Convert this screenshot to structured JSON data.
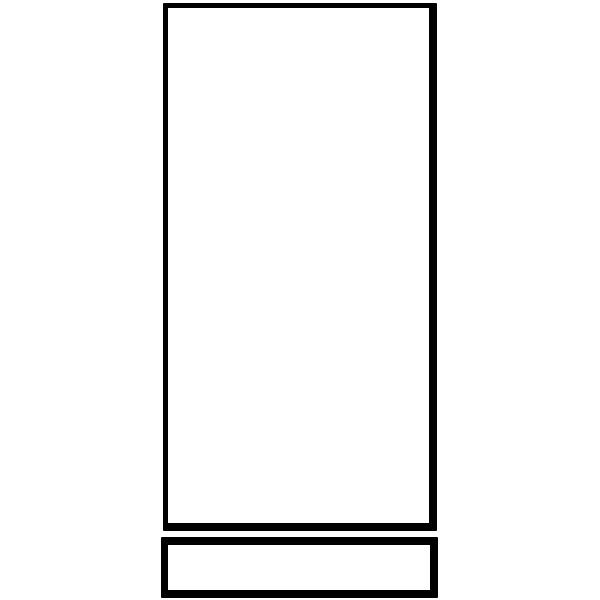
{
  "canvas": {
    "width": 600,
    "height": 600,
    "background": "#ffffff"
  },
  "colors": {
    "ink": "#000000",
    "fill": "#ffffff",
    "background": "#ffffff"
  },
  "drawing": {
    "description": "Black outline line drawing of a tall vertical rectangle panel with a short horizontal rectangle base below it; no text or labels",
    "shapes": {
      "main_panel": {
        "left": 163,
        "top": 3,
        "width": 274,
        "height": 528,
        "border_top": 5,
        "border_right": 8,
        "border_bottom": 8,
        "border_left": 5
      },
      "bottom_panel": {
        "left": 161,
        "top": 537,
        "width": 277,
        "height": 61,
        "border_top": 8,
        "border_right": 8,
        "border_bottom": 8,
        "border_left": 7
      }
    }
  }
}
